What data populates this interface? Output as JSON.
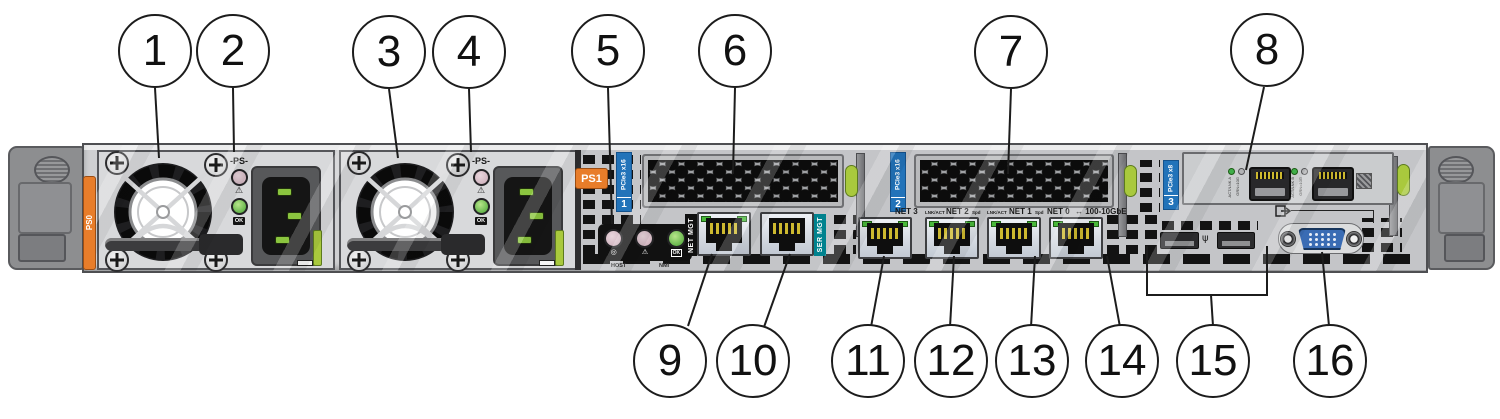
{
  "title": "Server rear panel callout diagram",
  "callouts": [
    "1",
    "2",
    "3",
    "4",
    "5",
    "6",
    "7",
    "8",
    "9",
    "10",
    "11",
    "12",
    "13",
    "14",
    "15",
    "16"
  ],
  "power_supplies": {
    "ps0_tag": "PS0",
    "ps1_tag": "PS1",
    "indicator_label": "-PS-",
    "ok_label": "OK"
  },
  "status_panel": {
    "host": "HOST",
    "nmi": "NMI",
    "ok": "OK"
  },
  "icons": {
    "warning": "⚠",
    "locate": "◎",
    "usb": "ψ"
  },
  "management": {
    "net_mgt": "NET MGT",
    "ser_mgt": "SER MGT"
  },
  "network": {
    "net3": "NET 3",
    "net2": "NET 2",
    "net1": "NET 1",
    "net0": "NET 0",
    "lnk_act": "LNK/ACT",
    "spd": "Spd",
    "speed_note": "↔ 100-10GbE"
  },
  "pcie": {
    "slot1_label": "PCIe3 x16",
    "slot1_num": "1",
    "slot2_label": "PCIe3 x16",
    "slot2_num": "2",
    "slot3_label": "PCIe3 x8",
    "slot3_num": "3"
  },
  "sfp": {
    "a_line1": "ACT/LNK A",
    "a_line2": "GRN=10G",
    "b_line1": "ACT/LNK B",
    "b_line2": "GRN=10G"
  },
  "colors": {
    "accent_orange": "#E87D2A",
    "pcie_blue": "#2273B9",
    "ser_mgt_teal": "#00828E",
    "latch_green": "#A9C93D",
    "led_green": "#49B93A",
    "vga_blue": "#3A6CB4"
  }
}
